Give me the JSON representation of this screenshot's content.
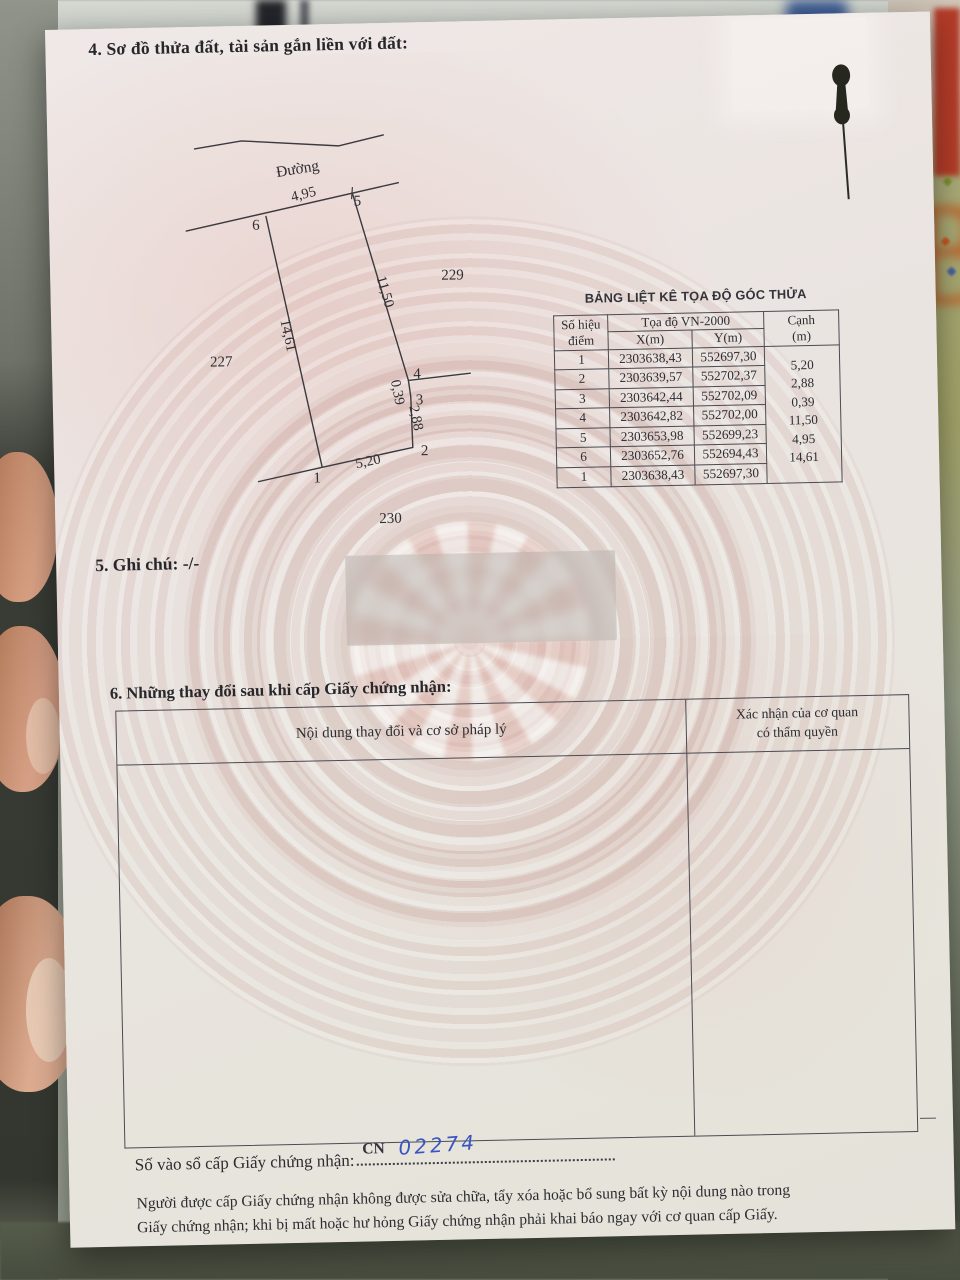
{
  "colors": {
    "ink_blue": "#3b55c0",
    "paper": "#eae4e1"
  },
  "page": {
    "section4_title": "4. Sơ đồ thửa đất, tài sản gắn liền với đất:",
    "section5_label": "5. Ghi chú:",
    "section5_value": "-/-",
    "section6_title": "6. Những thay đổi sau khi cấp Giấy chứng nhận:",
    "registry": {
      "label": "Số vào sổ cấp Giấy chứng nhận:",
      "prefix": "CN",
      "number": "02274"
    },
    "footer_line1": "Người được cấp Giấy chứng nhận không được sửa chữa, tẩy xóa hoặc bổ sung bất kỳ nội dung nào trong",
    "footer_line2": "Giấy chứng nhận; khi bị mất hoặc hư hỏng Giấy chứng nhận phải khai báo ngay với cơ quan cấp Giấy."
  },
  "diagram": {
    "road_label": "Đường",
    "neighbor_left": "227",
    "neighbor_right": "229",
    "neighbor_bottom": "230",
    "points": {
      "p1": "1",
      "p2": "2",
      "p3": "3",
      "p4": "4",
      "p5": "5",
      "p6": "6"
    },
    "lengths": {
      "l65": "4,95",
      "l54": "11,50",
      "l43": "0,39",
      "l32": "2,88",
      "l21": "5,20",
      "l16": "14,61"
    }
  },
  "coord_table": {
    "title": "BẢNG LIỆT KÊ TỌA ĐỘ GÓC THỬA",
    "headers": {
      "point_l1": "Số hiệu",
      "point_l2": "điểm",
      "group": "Tọa độ VN-2000",
      "x": "X(m)",
      "y": "Y(m)",
      "edge_l1": "Cạnh",
      "edge_l2": "(m)"
    },
    "rows": [
      {
        "id": "1",
        "x": "2303638,43",
        "y": "552697,30"
      },
      {
        "id": "2",
        "x": "2303639,57",
        "y": "552702,37"
      },
      {
        "id": "3",
        "x": "2303642,44",
        "y": "552702,09"
      },
      {
        "id": "4",
        "x": "2303642,82",
        "y": "552702,00"
      },
      {
        "id": "5",
        "x": "2303653,98",
        "y": "552699,23"
      },
      {
        "id": "6",
        "x": "2303652,76",
        "y": "552694,43"
      },
      {
        "id": "1b",
        "x": "2303638,43",
        "y": "552697,30",
        "id_display": "1"
      }
    ],
    "edges": [
      "5,20",
      "2,88",
      "0,39",
      "11,50",
      "4,95",
      "14,61"
    ]
  },
  "changes_table": {
    "col1_header": "Nội dung thay đổi và cơ sở pháp lý",
    "col2_header_l1": "Xác nhận của cơ quan",
    "col2_header_l2": "có thẩm quyền"
  },
  "background": {
    "letter_fragment": "B"
  }
}
